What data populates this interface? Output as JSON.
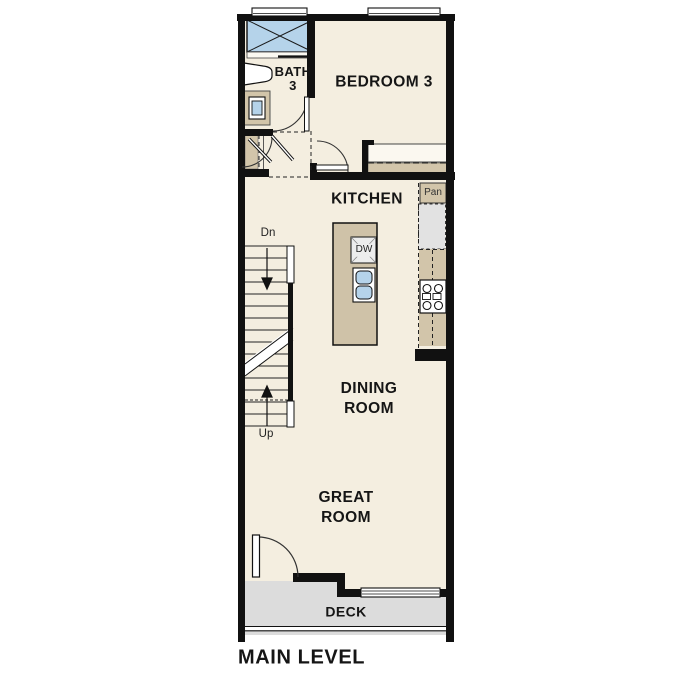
{
  "level": {
    "label": "MAIN LEVEL"
  },
  "rooms": [
    {
      "id": "bedroom-3",
      "label": "BEDROOM 3"
    },
    {
      "id": "bath-3",
      "label": "BATH\n3"
    },
    {
      "id": "kitchen",
      "label": "KITCHEN"
    },
    {
      "id": "dining-room",
      "label": "DINING\nROOM"
    },
    {
      "id": "great-room",
      "label": "GREAT\nROOM"
    },
    {
      "id": "deck",
      "label": "DECK"
    }
  ],
  "annotations": {
    "pantry": "Pan",
    "dishwasher": "DW",
    "stairs_down": "Dn",
    "stairs_up": "Up"
  },
  "colors": {
    "wall": "#111111",
    "floor": "#f4eee0",
    "cabinet": "#d2c5aa",
    "deck": "#dcdcdc",
    "appliance": "#e2e2e2",
    "water_fixture": "#b5d3ea",
    "background": "#ffffff"
  }
}
